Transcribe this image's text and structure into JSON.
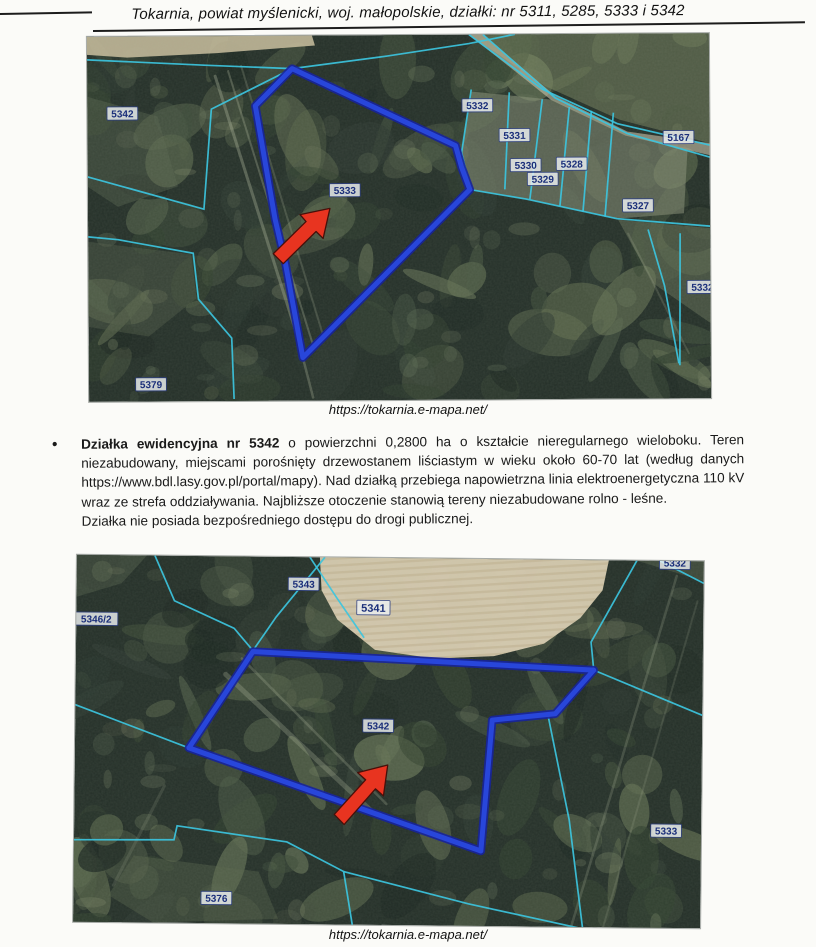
{
  "page": {
    "header_title": "Tokarnia, powiat myślenicki, woj. małopolskie, działki: nr 5311, 5285, 5333 i 5342",
    "bullet_char": "•",
    "paragraph": {
      "bold": "Działka ewidencyjna nr 5342",
      "rest": " o powierzchni 0,2800 ha o kształcie nieregularnego wieloboku. Teren niezabudowany, miejscami porośnięty drzewostanem liściastym w wieku około 60-70 lat (według danych https://www.bdl.lasy.gov.pl/portal/mapy). Nad działką przebiega napowietrzna linia elektroenergetyczna 110 kV wraz ze strefa oddziaływania. Najbliższe otoczenie stanowią tereny niezabudowane rolno - leśne.",
      "second_line": "Działka nie posiada bezpośredniego dostępu do drogi publicznej."
    },
    "map1_caption": "https://tokarnia.e-mapa.net/",
    "map2_caption": "https://tokarnia.e-mapa.net/"
  },
  "colors": {
    "boundary_cyan": "#3cc4de",
    "highlight_blue": "#2846da",
    "highlight_blue_dark": "#17249b",
    "arrow_red": "#e83420",
    "arrow_outline": "#47100a",
    "label_text": "#1b2f7a",
    "label_box": "#eef2f3",
    "label_border": "#2c3f86",
    "forest_dark": "#242f28",
    "field_tan": "#d8ccb1"
  },
  "map1": {
    "name": "parcel-5333-map",
    "width": 622,
    "height": 365,
    "highlight": "205,33 368,111 374,133 382,155 214,322 197,227 187,183 168,70",
    "arrow": "242,173 235,203 228,196 195,228 185,218 218,186 212,179",
    "boundaries": [
      "M 0 23 L 117 29 L 205 33 L 300 21 L 382 9 L 428 0",
      "M 0 140 L 116 173 L 124 73 L 203 34",
      "M 0 200 L 30 203 L 105 217 L 110 263 L 143 302 L 145 363",
      "M 382 155 L 439 165 L 529 185 L 622 193",
      "M 384 55 L 374 118 L 382 153",
      "M 422 58 L 417 155",
      "M 455 65 L 442 165",
      "M 482 73 L 472 172",
      "M 504 77 L 495 178",
      "M 526 79 L 517 183",
      "M 382 0 L 455 55 L 530 90 L 622 112",
      "M 396 0 L 468 64 L 540 100 L 622 124",
      "M 560 196 L 576 252 L 590 330",
      "M 592 200 L 591 332"
    ],
    "patches": [
      {
        "pts": "0,0 225,0 228,10 130,17 40,21 0,18",
        "fill": "#cbbf9f",
        "op": 0.85
      },
      {
        "pts": "382,0 622,0 622,110 532,86 458,52",
        "fill": "#7b8762",
        "op": 0.5
      },
      {
        "pts": "382,0 396,0 468,62 540,98 622,110 622,122 538,102 464,66",
        "fill": "#c9c2a8",
        "op": 0.6
      },
      {
        "pts": "374,118 382,155 439,165 529,185 596,180 600,115 540,99 468,66 384,57",
        "fill": "#8d957c",
        "op": 0.5
      },
      {
        "pts": "530,186 622,195 622,290 565,250",
        "fill": "#6e795d",
        "op": 0.45
      },
      {
        "pts": "0,205 103,218 108,262 60,300 0,290",
        "fill": "#4f5b47",
        "op": 0.45
      },
      {
        "pts": "0,60 70,80 90,150 30,170 0,150",
        "fill": "#5b6750",
        "op": 0.4
      }
    ],
    "streaks": [
      {
        "x1": 128,
        "y1": 40,
        "x2": 214,
        "y2": 318,
        "w": 3,
        "o": 0.35
      },
      {
        "x1": 141,
        "y1": 35,
        "x2": 225,
        "y2": 312,
        "w": 2,
        "o": 0.3
      },
      {
        "x1": 154,
        "y1": 30,
        "x2": 235,
        "y2": 302,
        "w": 2,
        "o": 0.22
      },
      {
        "x1": 214,
        "y1": 322,
        "x2": 224,
        "y2": 362,
        "w": 2.5,
        "o": 0.3
      },
      {
        "x1": 540,
        "y1": 200,
        "x2": 600,
        "y2": 320,
        "w": 2,
        "o": 0.2
      }
    ],
    "labels": [
      {
        "text": "5342",
        "x": 35,
        "y": 77
      },
      {
        "text": "5333",
        "x": 257,
        "y": 155
      },
      {
        "text": "5332",
        "x": 390,
        "y": 71
      },
      {
        "text": "5331",
        "x": 427,
        "y": 101
      },
      {
        "text": "5330",
        "x": 438,
        "y": 131
      },
      {
        "text": "5329",
        "x": 455,
        "y": 145
      },
      {
        "text": "5328",
        "x": 484,
        "y": 130
      },
      {
        "text": "5167",
        "x": 591,
        "y": 104
      },
      {
        "text": "5327",
        "x": 550,
        "y": 172
      },
      {
        "text": "5379",
        "x": 62,
        "y": 348
      },
      {
        "text": "5332",
        "x": 614,
        "y": 254
      }
    ]
  },
  "map2": {
    "name": "parcel-5342-map",
    "width": 627,
    "height": 367,
    "highlight": "177,95 518,110 480,154 417,161 407,292 114,192",
    "arrow": "313,207 309,238 301,231 270,267 260,257 291,222 283,215",
    "boundaries": [
      "M 78 0 L 98 45 L 158 72 L 177 94",
      "M 248 0 L 200 60 L 177 94",
      "M 233 0 L 260 40 L 288 80",
      "M 560 0 L 515 82 L 518 110",
      "M 518 110 L 627 154",
      "M 473 157 L 495 260 L 510 372",
      "M 0 285 L 100 284 L 103 270 L 213 285 L 270 314 L 280 372",
      "M 270 314 L 395 345 L 525 372",
      "M 0 150 L 114 192",
      "M 583 0 L 627 22"
    ],
    "patches": [
      {
        "pts": "243,0 532,0 526,30 504,58 468,84 418,97 358,100 299,92 261,62 245,33",
        "fill": "#d8ccb1",
        "op": 0.96,
        "stripes": true
      },
      {
        "pts": "0,0 70,0 45,28 0,42",
        "fill": "#5a6650",
        "op": 0.4
      },
      {
        "pts": "60,300 185,315 205,362 80,367 35,340",
        "fill": "#57634c",
        "op": 0.4
      },
      {
        "pts": "560,0 627,0 627,20 600,12",
        "fill": "#6a765a",
        "op": 0.35
      }
    ],
    "streaks": [
      {
        "x1": 150,
        "y1": 118,
        "x2": 298,
        "y2": 254,
        "w": 5,
        "o": 0.28
      },
      {
        "x1": 166,
        "y1": 102,
        "x2": 312,
        "y2": 246,
        "w": 2.5,
        "o": 0.25
      },
      {
        "x1": 600,
        "y1": 15,
        "x2": 498,
        "y2": 367,
        "w": 2.5,
        "o": 0.22
      },
      {
        "x1": 621,
        "y1": 40,
        "x2": 530,
        "y2": 367,
        "w": 2,
        "o": 0.16
      },
      {
        "x1": 90,
        "y1": 230,
        "x2": 40,
        "y2": 330,
        "w": 3,
        "o": 0.15
      }
    ],
    "labels": [
      {
        "text": "5343",
        "x": 227,
        "y": 27
      },
      {
        "text": "5341",
        "x": 297,
        "y": 50,
        "fs": 11
      },
      {
        "text": "5346/2",
        "x": 20,
        "y": 64
      },
      {
        "text": "5342",
        "x": 303,
        "y": 168
      },
      {
        "text": "5333",
        "x": 592,
        "y": 270
      },
      {
        "text": "5376",
        "x": 143,
        "y": 342
      },
      {
        "text": "5332",
        "x": 598,
        "y": 2
      }
    ]
  }
}
